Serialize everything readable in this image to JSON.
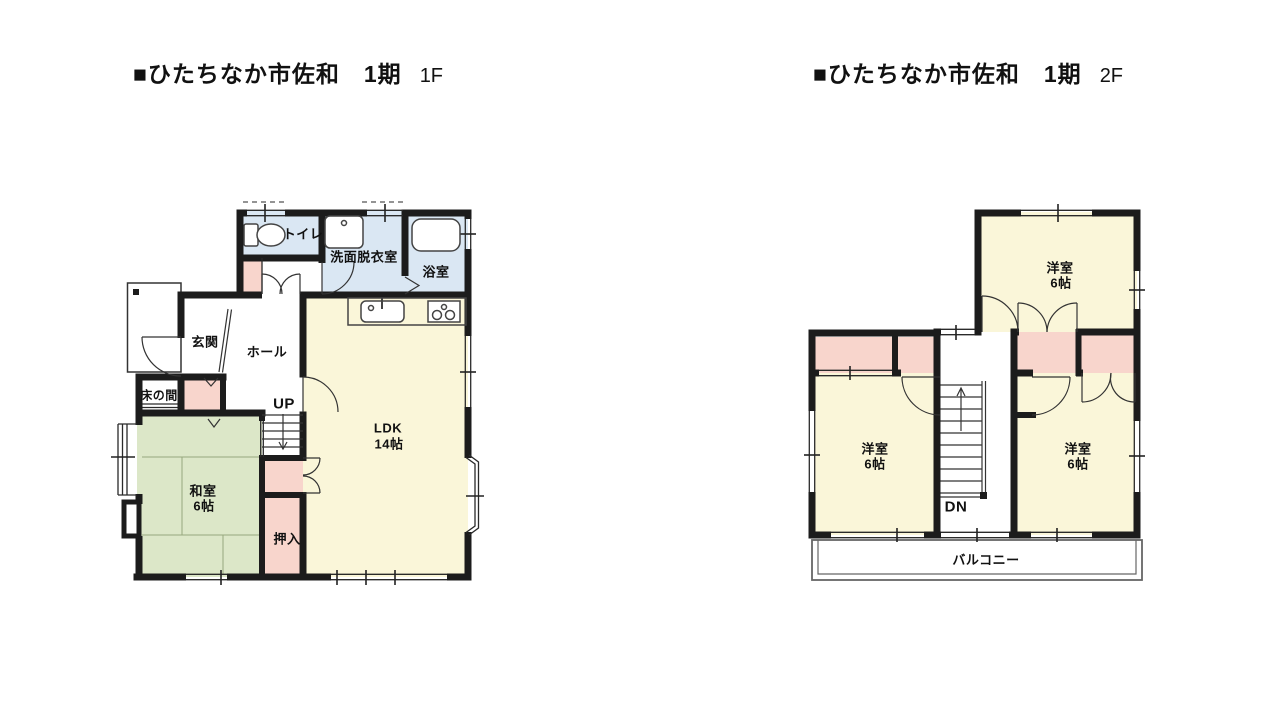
{
  "floor1": {
    "title_main": "■ひたちなか市佐和　1期",
    "title_floor": "1F",
    "labels": {
      "toilet": "トイレ",
      "washroom": "洗面脱衣室",
      "bathroom": "浴室",
      "entrance": "玄関",
      "hall": "ホール",
      "tokonoma": "床の間",
      "stairs_up": "UP",
      "ldk_name": "LDK",
      "ldk_size": "14帖",
      "washitsu_name": "和室",
      "washitsu_size": "6帖",
      "oshiire": "押入"
    }
  },
  "floor2": {
    "title_main": "■ひたちなか市佐和　1期",
    "title_floor": "2F",
    "labels": {
      "room_ne_name": "洋室",
      "room_ne_size": "6帖",
      "room_w_name": "洋室",
      "room_w_size": "6帖",
      "room_se_name": "洋室",
      "room_se_size": "6帖",
      "stairs_down": "DN",
      "balcony": "バルコニー"
    }
  },
  "colors": {
    "wall": "#1c1c1c",
    "line": "#2a2a2a",
    "room-yellow": "#FAF6D9",
    "room-green": "#DCE7C8",
    "room-pink": "#F8D5CC",
    "room-blue": "#DAE7F3"
  }
}
